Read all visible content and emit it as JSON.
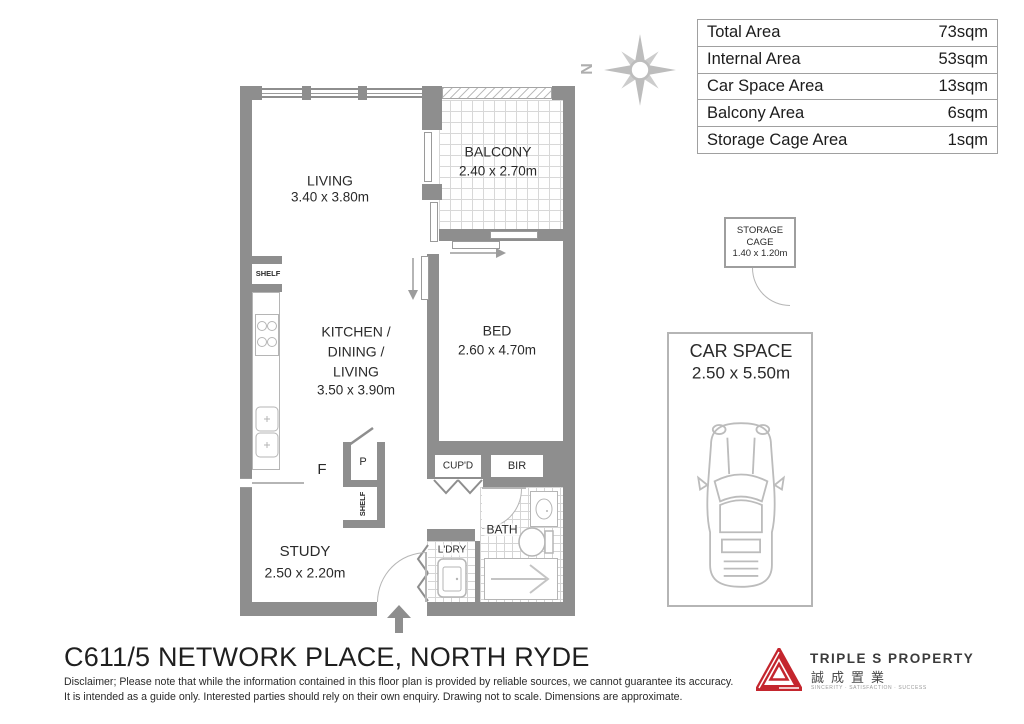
{
  "page": {
    "title": "C611/5 NETWORK PLACE, NORTH RYDE",
    "disclaimer_line1": "Disclaimer; Please note that while the information contained in this floor plan is provided by reliable sources, we cannot guarantee its accuracy.",
    "disclaimer_line2": "It is intended as a guide only. Interested parties should rely on their own enquiry. Drawing not to scale. Dimensions are approximate."
  },
  "area_table": {
    "rows": [
      {
        "label": "Total Area",
        "value": "73sqm"
      },
      {
        "label": "Internal Area",
        "value": "53sqm"
      },
      {
        "label": "Car Space Area",
        "value": "13sqm"
      },
      {
        "label": "Balcony Area",
        "value": "6sqm"
      },
      {
        "label": "Storage Cage Area",
        "value": "1sqm"
      }
    ]
  },
  "compass": {
    "north_label": "N"
  },
  "floor_plan": {
    "living": {
      "name": "LIVING",
      "dims": "3.40 x 3.80m"
    },
    "balcony": {
      "name": "BALCONY",
      "dims": "2.40 x 2.70m"
    },
    "kitchen": {
      "line1": "KITCHEN /",
      "line2": "DINING /",
      "line3": "LIVING",
      "dims": "3.50 x 3.90m"
    },
    "bed": {
      "name": "BED",
      "dims": "2.60 x 4.70m"
    },
    "study": {
      "name": "STUDY",
      "dims": "2.50 x 2.20m"
    },
    "labels": {
      "shelf_top": "SHELF",
      "shelf_vertical": "SHELF",
      "fridge": "F",
      "pantry": "P",
      "cupboard": "CUP'D",
      "robe": "BIR",
      "bath": "BATH",
      "laundry": "L'DRY"
    }
  },
  "storage_cage": {
    "line1": "STORAGE",
    "line2": "CAGE",
    "dims": "1.40 x 1.20m"
  },
  "car_space": {
    "name": "CAR SPACE",
    "dims": "2.50 x 5.50m"
  },
  "logo": {
    "brand": "TRIPLE S PROPERTY",
    "chinese": "誠成置業",
    "tagline": "SINCERITY · SATISFACTION · SUCCESS"
  },
  "colors": {
    "wall": "#8e8e8e",
    "fixture": "#b5b5b5",
    "text": "#262626",
    "logo_red": "#c4262e"
  }
}
